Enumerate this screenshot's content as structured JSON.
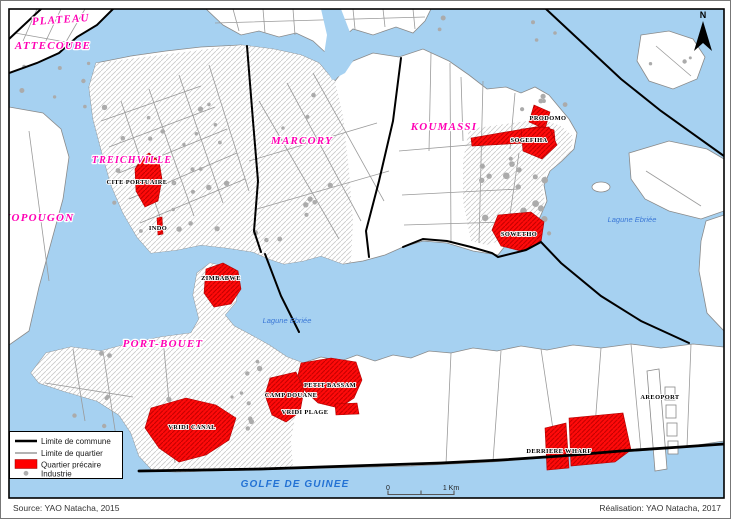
{
  "communes": {
    "plateau": "PLATEAU",
    "attecoube": "ATTECOUBE",
    "yopougon": "YOPOUGON",
    "treichville": "TREICHVILLE",
    "marcory": "MARCORY",
    "koumassi": "KOUMASSI",
    "port_bouet": "PORT-BOUET"
  },
  "quartiers": {
    "cite_portuaire": "CITE PORTUAIRE",
    "indo": "INDO",
    "zimbabwe": "ZIMBABWE",
    "prodomo": "PRODOMO",
    "sogefiha": "SOGEFIHA",
    "sowetho": "SOWETHO",
    "petit_bassam": "PETIT BASSAM",
    "camp_douane": "CAMP DOUANE",
    "vridi_plage": "VRIDI PLAGE",
    "vridi_canal": "VRIDI CANAL",
    "derriere_wharf": "DERRIERE WHARF"
  },
  "places": {
    "aeroport": "AREOPORT"
  },
  "water": {
    "lagune_1": "Lagune Ebriée",
    "lagune_2": "Lagune Ebriée",
    "golfe": "GOLFE DE GUINEE"
  },
  "legend": {
    "commune": "Limite de commune",
    "quartier": "Limite de quartier",
    "precaire": "Quartier précaire",
    "industrie": "Industrie"
  },
  "scale": {
    "zero": "0",
    "one_km": "1 Km"
  },
  "compass": {
    "north": "N"
  },
  "footer": {
    "source": "Source: YAO Natacha, 2015",
    "realisation": "Réalisation: YAO Natacha, 2017"
  },
  "colors": {
    "water": "#A6D1F1",
    "precaire": "#FF0000",
    "commune_label": "#FF00B4",
    "water_label": "#3A77D6"
  }
}
